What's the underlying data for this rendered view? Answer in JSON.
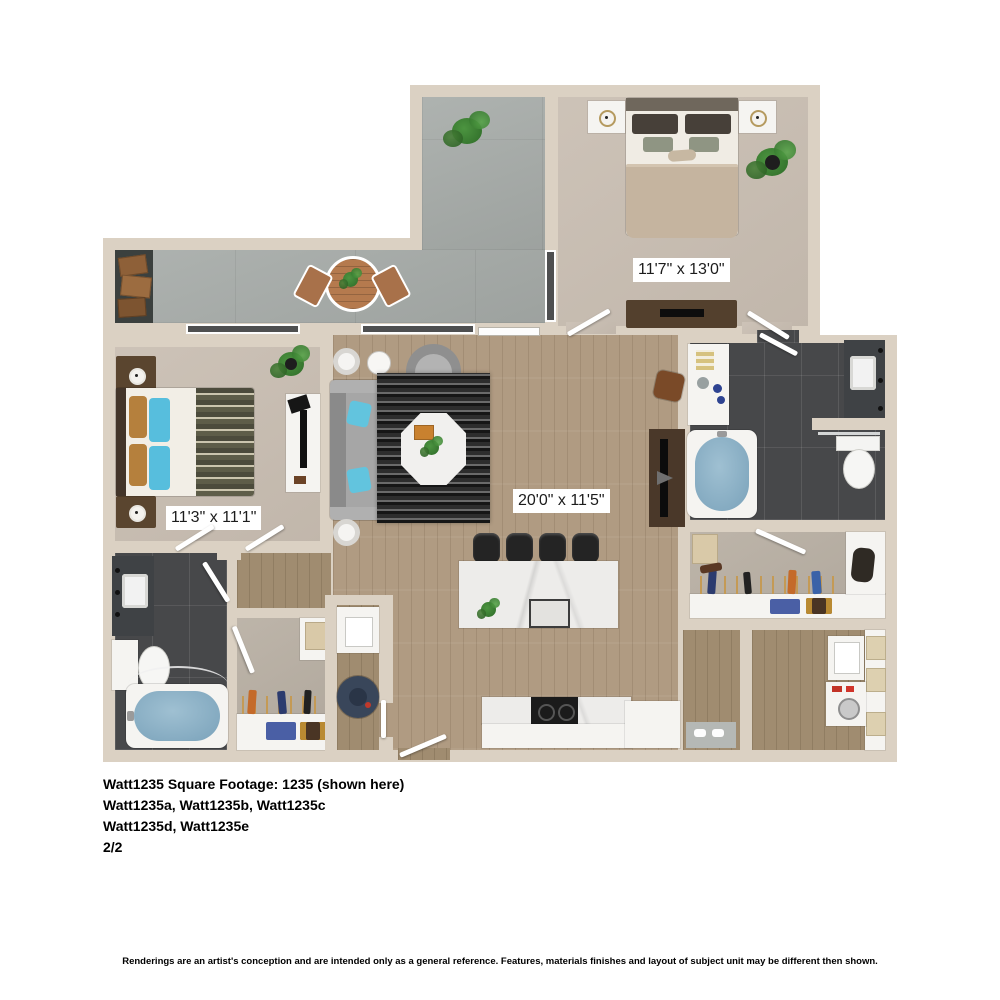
{
  "floorplan": {
    "rooms": {
      "bedroom1": {
        "name": "bedroom",
        "dimensions": "11'7\" x 13'0\""
      },
      "bedroom2": {
        "name": "bedroom",
        "dimensions": "11'3\" x 11'1\""
      },
      "living_room": {
        "name": "living room",
        "dimensions": "20'0\" x 11'5\""
      }
    },
    "colors": {
      "wall": "#dbd1c3",
      "concrete": "#a7aca9",
      "carpet": "#c9beb2",
      "wood_floor": "#b09b82",
      "dark_tile": "#47484a",
      "closet_carpet": "#b9b0a4",
      "tub_blue": "#84abc1",
      "pillow_blue": "#57bedd"
    }
  },
  "footer": {
    "lines": [
      "Watt1235 Square Footage: 1235 (shown here)",
      "Watt1235a, Watt1235b, Watt1235c",
      "Watt1235d, Watt1235e",
      "2/2"
    ]
  },
  "disclaimer": "Renderings are an artist's conception and are intended only as a general reference. Features, materials finishes and layout of subject unit may be different then shown."
}
